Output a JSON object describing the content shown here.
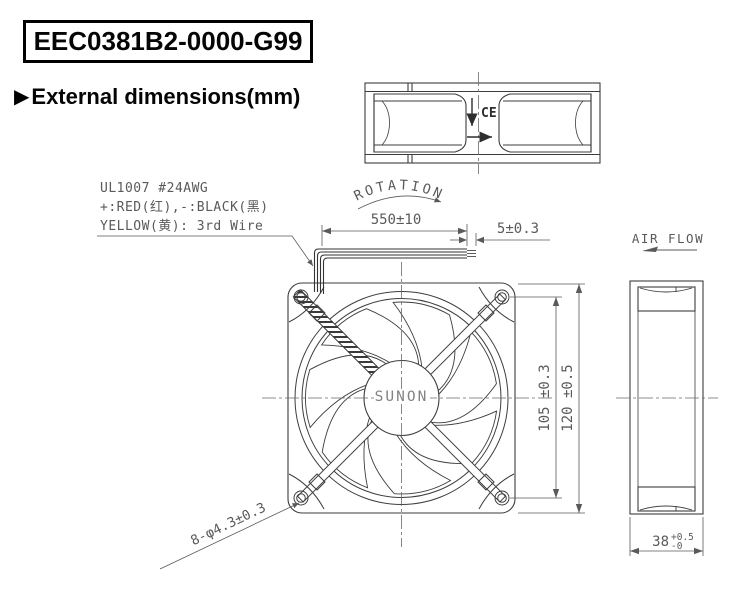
{
  "header": {
    "part_number": "EEC0381B2-0000-G99",
    "section_marker": "▶",
    "section_title": "External dimensions(mm)"
  },
  "wire_spec": {
    "line1": "UL1007 #24AWG",
    "line2": "+:RED(红),-:BLACK(黑)",
    "line3": "YELLOW(黄): 3rd Wire"
  },
  "labels": {
    "rotation": "ROTATION",
    "air_flow": "AIR FLOW",
    "brand": "SUNON",
    "ce_mark": "CE"
  },
  "dims": {
    "wire_length": "550±10",
    "strip_length": "5±0.3",
    "hole_pitch": "105 ±0.3",
    "frame_size": "120 ±0.5",
    "mounting_holes": "8-φ4.3±0.3",
    "depth_value": "38",
    "depth_tol_plus": "+0.5",
    "depth_tol_minus": "-0"
  },
  "colors": {
    "geometry_line": "#3d3d3d",
    "dimension_line": "#5a5a5a",
    "title_text": "#050505",
    "background": "#ffffff"
  }
}
